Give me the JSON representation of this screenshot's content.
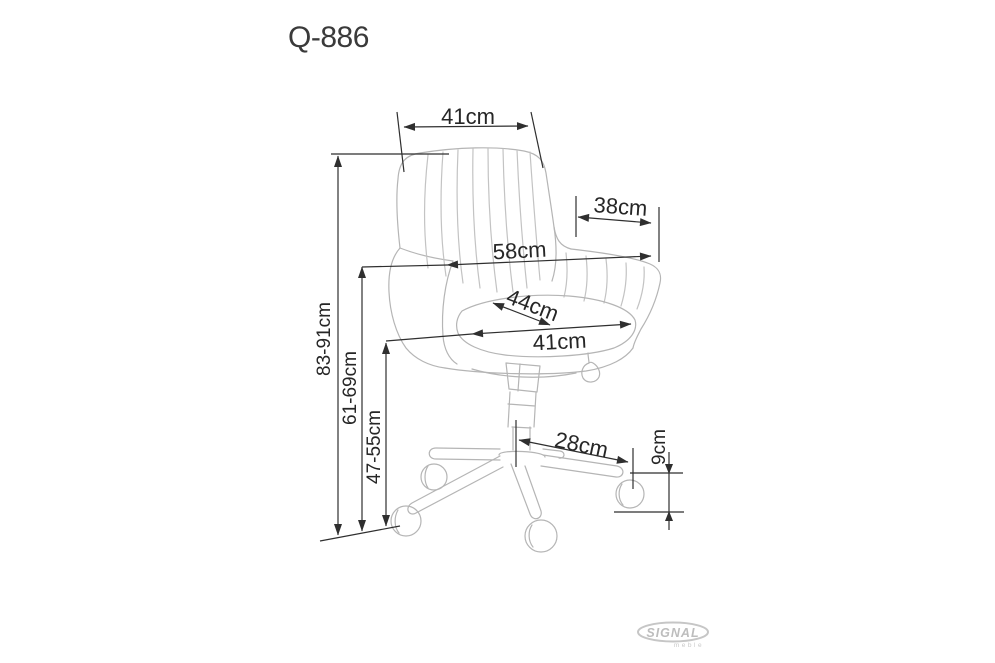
{
  "title": "Q-886",
  "drawing": {
    "subject": "office swivel chair technical dimension drawing",
    "dimensions": {
      "back_width": "41cm",
      "arm_depth": "38cm",
      "overall_width": "58cm",
      "seat_depth": "44cm",
      "seat_width": "41cm",
      "overall_height": "83-91cm",
      "arm_height": "61-69cm",
      "seat_height": "47-55cm",
      "base_leg_reach": "28cm",
      "caster_height": "9cm"
    }
  },
  "logo": {
    "brand": "SIGNAL",
    "sub": "meble"
  },
  "colors": {
    "background": "#ffffff",
    "chair_line": "#b5b5b5",
    "dimension_line": "#2f2f2f",
    "label_text": "#262626",
    "title_text": "#3a3a3a",
    "logo_gray": "#c6c6c6"
  }
}
